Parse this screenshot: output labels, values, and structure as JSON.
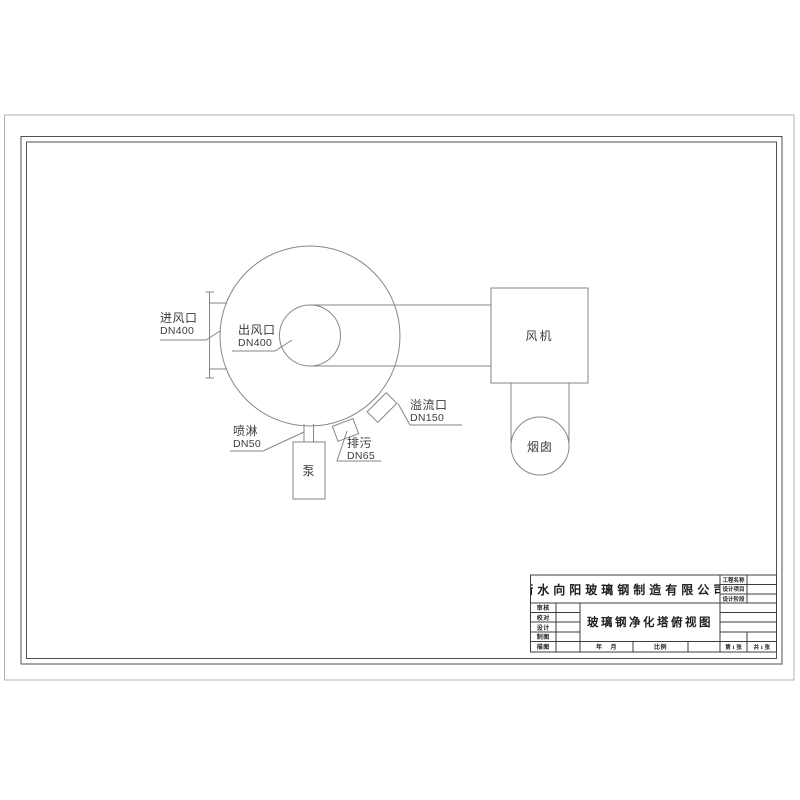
{
  "drawing": {
    "labels": {
      "inlet": {
        "name": "进风口",
        "size": "DN400"
      },
      "outlet": {
        "name": "出风口",
        "size": "DN400"
      },
      "spray": {
        "name": "喷淋",
        "size": "DN50"
      },
      "drain": {
        "name": "排污",
        "size": "DN65"
      },
      "overflow": {
        "name": "溢流口",
        "size": "DN150"
      },
      "pump": "泵",
      "fan": "风机",
      "chimney": "烟囱"
    }
  },
  "title_block": {
    "company": "衡水向阳玻璃钢制造有限公司",
    "drawing_title": "玻璃钢净化塔俯视图",
    "fields": {
      "project_name": "工程名称",
      "design_item": "设计项目",
      "design_stage": "设计阶段",
      "review": "审核",
      "proof": "校对",
      "design": "设计",
      "draft": "制图",
      "trace": "描图",
      "date": "年    月",
      "scale": "比例",
      "sheet_no": "第 1 张",
      "sheet_total": "共 1 张"
    }
  },
  "colors": {
    "line_gray": "#868686",
    "frame_gray": "#525252",
    "outer_border": "#b3b3b3",
    "titleblock_line": "#3d3d3d"
  }
}
